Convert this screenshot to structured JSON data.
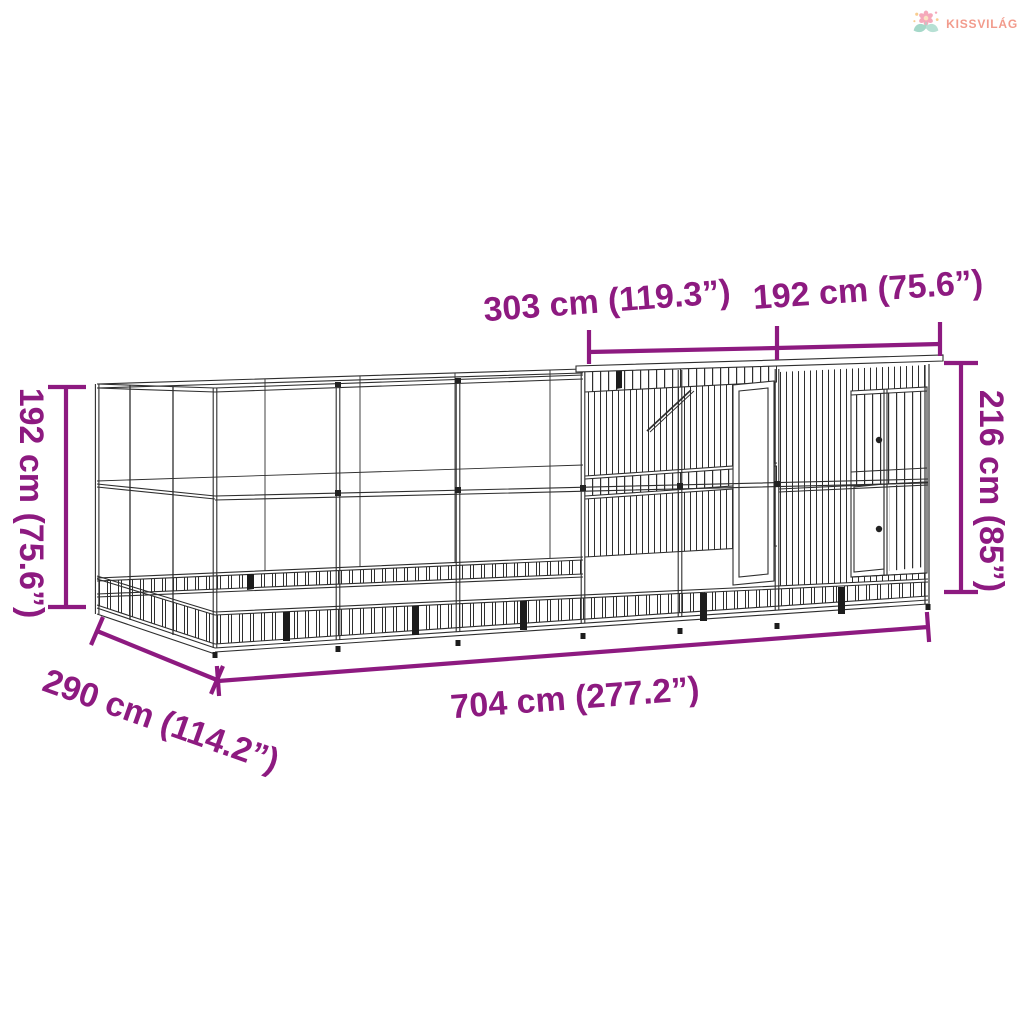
{
  "page": {
    "background": "#ffffff"
  },
  "logo": {
    "brand": "KISSVILÁG",
    "icon": "flower-sprout-logo-icon",
    "text_color": "#F29B8C"
  },
  "annotations": {
    "color": "#8D1A80",
    "top_extension_width": "303 cm (119.3”)",
    "top_coop_width": "192 cm (75.6”)",
    "left_height": "192 cm (75.6”)",
    "right_height": "216 cm (85”)",
    "bottom_total_length": "704 cm (277.2”)",
    "front_depth": "290 cm (114.2”)"
  }
}
